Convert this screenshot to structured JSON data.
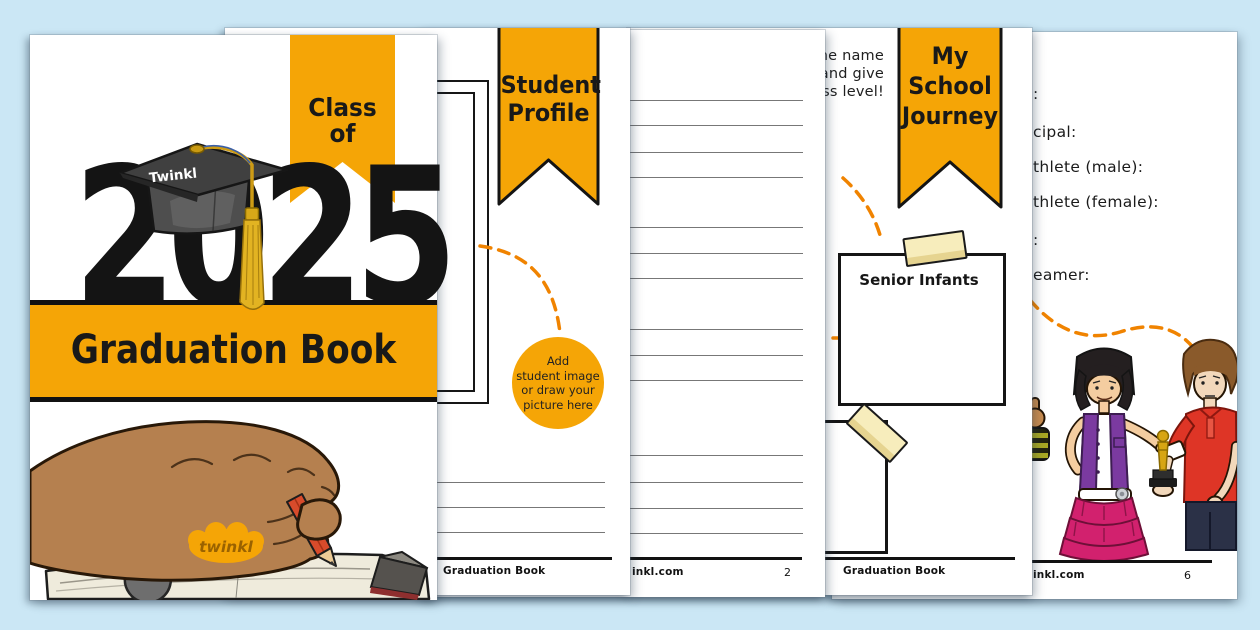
{
  "colors": {
    "background": "#CBE7F5",
    "accent_orange": "#F5A506",
    "dash_orange": "#F08300"
  },
  "cover": {
    "ribbon_label": "Class of",
    "year": "2025",
    "cap_brand": "Twinkl",
    "title": "Graduation Book",
    "logo_text": "twinkl"
  },
  "student_profile": {
    "ribbon_lines": [
      "Student",
      "Profile"
    ],
    "circle_note_lines": [
      "Add",
      "student image",
      "or draw your",
      "picture here"
    ],
    "footer_left": "Graduation Book"
  },
  "lined_page": {
    "footer_left": "inkl.com",
    "page_number": "2"
  },
  "school_journey": {
    "intro_fragments": [
      "the name",
      "and give",
      "ass level!"
    ],
    "ribbon_lines": [
      "My",
      "School",
      "Journey"
    ],
    "box_label": "Senior Infants",
    "footer_left": "Graduation Book"
  },
  "awards_page": {
    "field_fragments": [
      ":",
      "cipal:",
      "thlete (male):",
      "thlete (female):",
      ":",
      "eamer:"
    ],
    "footer_left": "inkl.com",
    "page_number": "6"
  }
}
